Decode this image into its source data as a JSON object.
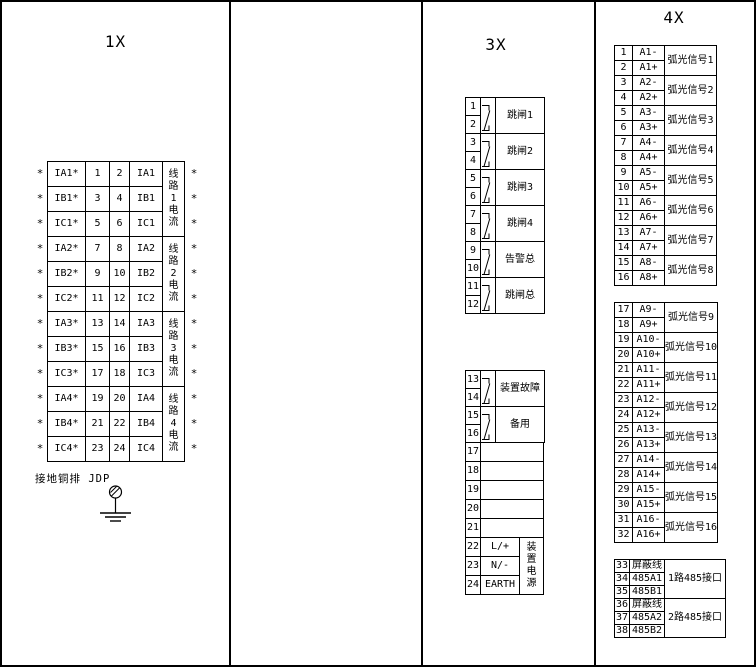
{
  "colors": {
    "line": "#000000",
    "background": "#ffffff"
  },
  "panels": {
    "x1": {
      "title": "1X",
      "star": "*",
      "ground_label": "接地铜排 JDP",
      "groups": [
        "线路1电流",
        "线路2电流",
        "线路3电流",
        "线路4电流"
      ],
      "rows": [
        {
          "left": "IA1*",
          "n1": "1",
          "n2": "2",
          "right": "IA1"
        },
        {
          "left": "IB1*",
          "n1": "3",
          "n2": "4",
          "right": "IB1"
        },
        {
          "left": "IC1*",
          "n1": "5",
          "n2": "6",
          "right": "IC1"
        },
        {
          "left": "IA2*",
          "n1": "7",
          "n2": "8",
          "right": "IA2"
        },
        {
          "left": "IB2*",
          "n1": "9",
          "n2": "10",
          "right": "IB2"
        },
        {
          "left": "IC2*",
          "n1": "11",
          "n2": "12",
          "right": "IC2"
        },
        {
          "left": "IA3*",
          "n1": "13",
          "n2": "14",
          "right": "IA3"
        },
        {
          "left": "IB3*",
          "n1": "15",
          "n2": "16",
          "right": "IB3"
        },
        {
          "left": "IC3*",
          "n1": "17",
          "n2": "18",
          "right": "IC3"
        },
        {
          "left": "IA4*",
          "n1": "19",
          "n2": "20",
          "right": "IA4"
        },
        {
          "left": "IB4*",
          "n1": "21",
          "n2": "22",
          "right": "IB4"
        },
        {
          "left": "IC4*",
          "n1": "23",
          "n2": "24",
          "right": "IC4"
        }
      ]
    },
    "x3": {
      "title": "3X",
      "relay_blocks": [
        {
          "t": [
            "1",
            "2"
          ],
          "label": "跳闸1"
        },
        {
          "t": [
            "3",
            "4"
          ],
          "label": "跳闸2"
        },
        {
          "t": [
            "5",
            "6"
          ],
          "label": "跳闸3"
        },
        {
          "t": [
            "7",
            "8"
          ],
          "label": "跳闸4"
        },
        {
          "t": [
            "9",
            "10"
          ],
          "label": "告警总"
        },
        {
          "t": [
            "11",
            "12"
          ],
          "label": "跳闸总"
        }
      ],
      "relay_blocks2": [
        {
          "t": [
            "13",
            "14"
          ],
          "label": "装置故障"
        },
        {
          "t": [
            "15",
            "16"
          ],
          "label": "备用"
        }
      ],
      "spare_terminals": [
        "17",
        "18",
        "19",
        "20",
        "21"
      ],
      "power_rows": [
        {
          "t": "22",
          "label": "L/+"
        },
        {
          "t": "23",
          "label": "N/-"
        },
        {
          "t": "24",
          "label": "EARTH"
        }
      ],
      "power_group": "装置电源"
    },
    "x4": {
      "title": "4X",
      "signal_groups_1": [
        {
          "t1": "1",
          "a1": "A1-",
          "t2": "2",
          "a2": "A1+",
          "label": "弧光信号1"
        },
        {
          "t1": "3",
          "a1": "A2-",
          "t2": "4",
          "a2": "A2+",
          "label": "弧光信号2"
        },
        {
          "t1": "5",
          "a1": "A3-",
          "t2": "6",
          "a2": "A3+",
          "label": "弧光信号3"
        },
        {
          "t1": "7",
          "a1": "A4-",
          "t2": "8",
          "a2": "A4+",
          "label": "弧光信号4"
        },
        {
          "t1": "9",
          "a1": "A5-",
          "t2": "10",
          "a2": "A5+",
          "label": "弧光信号5"
        },
        {
          "t1": "11",
          "a1": "A6-",
          "t2": "12",
          "a2": "A6+",
          "label": "弧光信号6"
        },
        {
          "t1": "13",
          "a1": "A7-",
          "t2": "14",
          "a2": "A7+",
          "label": "弧光信号7"
        },
        {
          "t1": "15",
          "a1": "A8-",
          "t2": "16",
          "a2": "A8+",
          "label": "弧光信号8"
        }
      ],
      "signal_groups_2": [
        {
          "t1": "17",
          "a1": "A9-",
          "t2": "18",
          "a2": "A9+",
          "label": "弧光信号9"
        },
        {
          "t1": "19",
          "a1": "A10-",
          "t2": "20",
          "a2": "A10+",
          "label": "弧光信号10"
        },
        {
          "t1": "21",
          "a1": "A11-",
          "t2": "22",
          "a2": "A11+",
          "label": "弧光信号11"
        },
        {
          "t1": "23",
          "a1": "A12-",
          "t2": "24",
          "a2": "A12+",
          "label": "弧光信号12"
        },
        {
          "t1": "25",
          "a1": "A13-",
          "t2": "26",
          "a2": "A13+",
          "label": "弧光信号13"
        },
        {
          "t1": "27",
          "a1": "A14-",
          "t2": "28",
          "a2": "A14+",
          "label": "弧光信号14"
        },
        {
          "t1": "29",
          "a1": "A15-",
          "t2": "30",
          "a2": "A15+",
          "label": "弧光信号15"
        },
        {
          "t1": "31",
          "a1": "A16-",
          "t2": "32",
          "a2": "A16+",
          "label": "弧光信号16"
        }
      ],
      "rs485_groups": [
        {
          "terminals": [
            [
              "33",
              "屏蔽线"
            ],
            [
              "34",
              "485A1"
            ],
            [
              "35",
              "485B1"
            ]
          ],
          "label": "1路485接口"
        },
        {
          "terminals": [
            [
              "36",
              "屏蔽线"
            ],
            [
              "37",
              "485A2"
            ],
            [
              "38",
              "485B2"
            ]
          ],
          "label": "2路485接口"
        }
      ]
    }
  }
}
